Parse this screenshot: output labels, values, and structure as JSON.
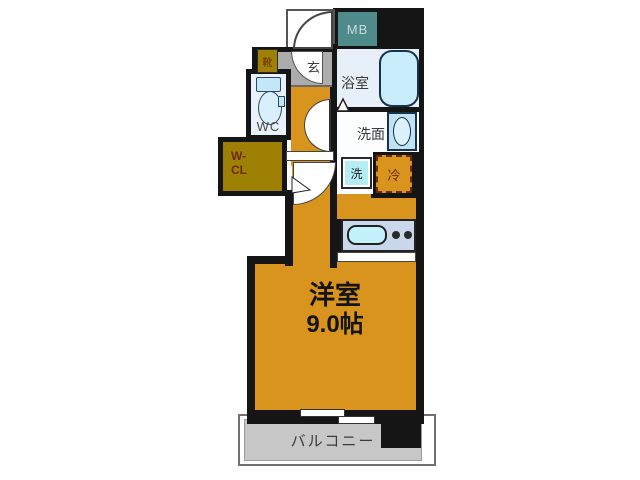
{
  "floor_plan": {
    "main_room": {
      "name": "洋室",
      "size": "9.0帖"
    },
    "balcony": {
      "name": "バルコニー"
    },
    "bathroom": {
      "name": "浴室"
    },
    "washroom": {
      "name": "洗面"
    },
    "washing_machine": {
      "name": "洗"
    },
    "refrigerator": {
      "name": "冷"
    },
    "toilet": {
      "name": "WC"
    },
    "walk_in_closet": {
      "name": "W-CL",
      "line1": "W-",
      "line2": "CL"
    },
    "entrance": {
      "name": "玄"
    },
    "shoe_cabinet": {
      "name": "靴"
    },
    "meter_box": {
      "name": "MB"
    },
    "colors": {
      "room_floor": "#D8941C",
      "closet_floor": "#9E8104",
      "meter_box_fill": "#4F8B8B",
      "entrance_floor": "#ACACAC",
      "balcony_floor": "#C7C7C7",
      "wall": "#151515",
      "fixture_blue": "#C9EDFB",
      "closet_text": "#6B2A00"
    }
  }
}
